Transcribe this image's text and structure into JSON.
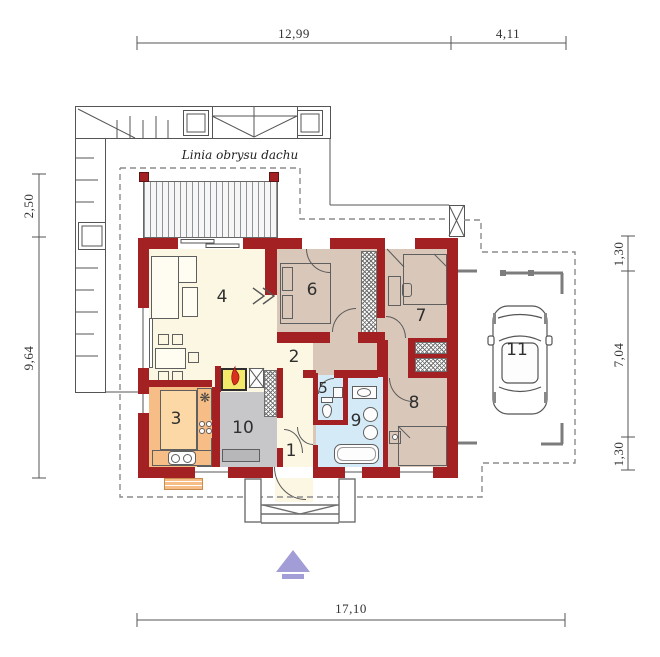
{
  "roof_outline_label": "Linia obrysu dachu",
  "room_numbers": [
    "1",
    "2",
    "3",
    "4",
    "5",
    "6",
    "7",
    "8",
    "9",
    "10",
    "11"
  ],
  "dimensions": {
    "top": [
      "12,99",
      "4,11"
    ],
    "left": [
      "2,50",
      "9,64"
    ],
    "right": [
      "1,30",
      "7,04",
      "1,30"
    ],
    "bottom": [
      "17,10"
    ]
  },
  "colors": {
    "wall": "#a32023",
    "floor_cream": "#fcf7e3",
    "floor_tan": "#d9c8ba",
    "floor_orange": "#f6bd86",
    "floor_gray": "#c7c7c9",
    "floor_blue": "#d4eaf7",
    "fireplace_yellow": "#f3e96b",
    "flame_red": "#d9301f",
    "entrance_arrow": "#a29dd6",
    "kitchen_table": "#fbd8a5"
  }
}
